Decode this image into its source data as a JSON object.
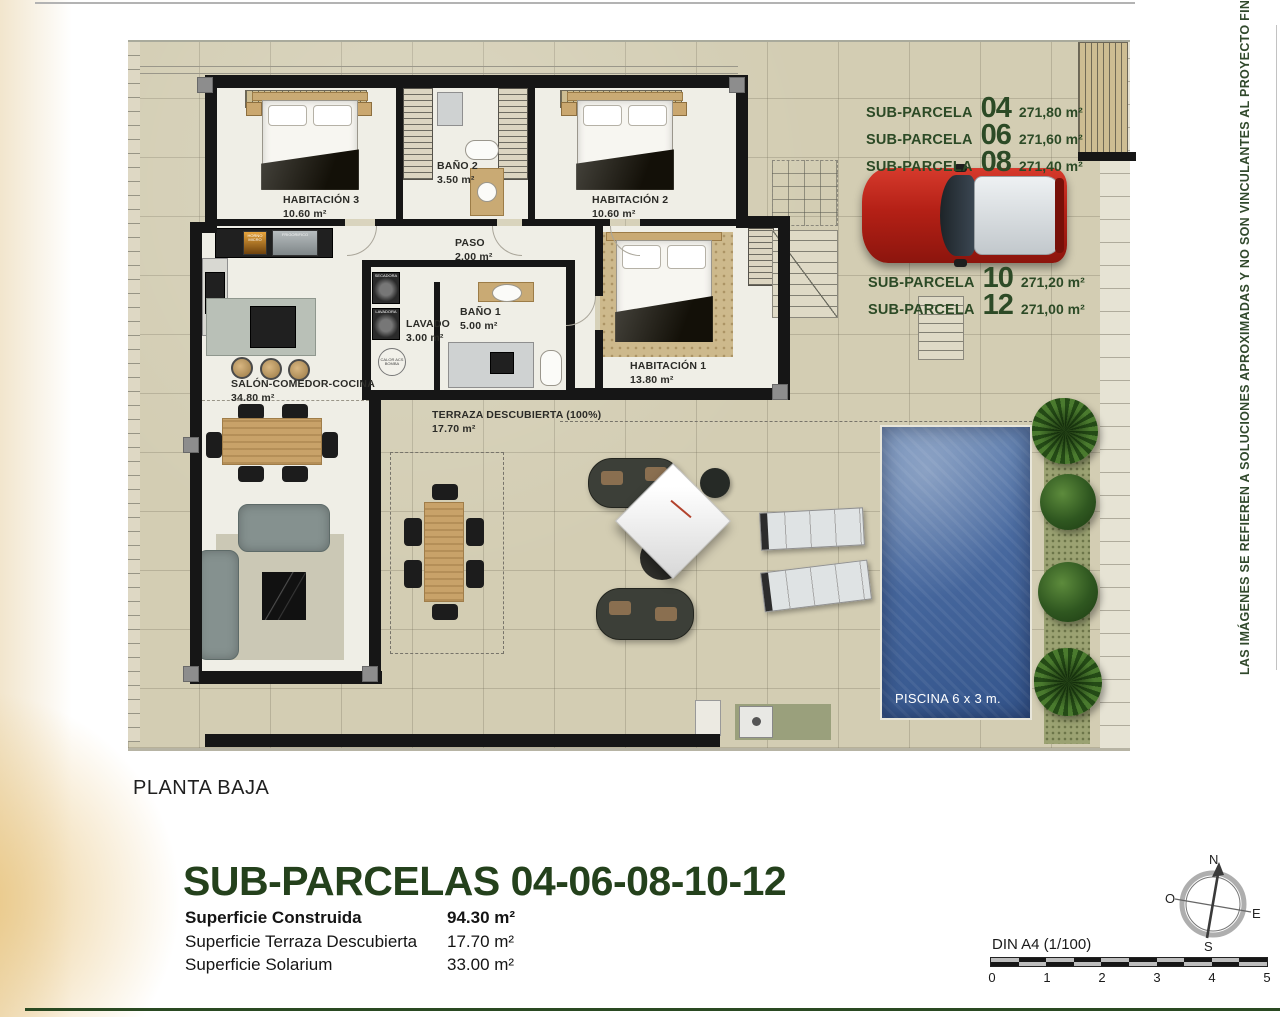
{
  "parcels": {
    "top": [
      {
        "name": "SUB-PARCELA",
        "num": "04",
        "area": "271,80 m²"
      },
      {
        "name": "SUB-PARCELA",
        "num": "06",
        "area": "271,60 m²"
      },
      {
        "name": "SUB-PARCELA",
        "num": "08",
        "area": "271,40 m²"
      }
    ],
    "mid": [
      {
        "name": "SUB-PARCELA",
        "num": "10",
        "area": "271,20 m²"
      },
      {
        "name": "SUB-PARCELA",
        "num": "12",
        "area": "271,00 m²"
      }
    ]
  },
  "rooms": {
    "hab3": {
      "name": "HABITACIÓN 3",
      "area": "10.60 m²"
    },
    "bano2": {
      "name": "BAÑO 2",
      "area": "3.50 m²"
    },
    "hab2": {
      "name": "HABITACIÓN 2",
      "area": "10.60 m²"
    },
    "paso": {
      "name": "PASO",
      "area": "2.00 m²"
    },
    "lavado": {
      "name": "LAVADO",
      "area": "3.00 m²"
    },
    "bano1": {
      "name": "BAÑO 1",
      "area": "5.00 m²"
    },
    "hab1": {
      "name": "HABITACIÓN 1",
      "area": "13.80 m²"
    },
    "salon": {
      "name": "SALÓN-COMEDOR-COCINA",
      "area": "34.80 m²"
    },
    "terraza": {
      "name": "TERRAZA DESCUBIERTA (100%)",
      "area": "17.70 m²"
    }
  },
  "appliances": {
    "oven": "HORNO MICRO",
    "fridge": "FRIGORIFICO",
    "dryer": "SECADORA",
    "washer": "LAVADORA",
    "boiler": "CALOR ACS BOMBA"
  },
  "pool": {
    "label": "PISCINA 6 x 3 m."
  },
  "floor": {
    "label": "PLANTA BAJA"
  },
  "title": {
    "text": "SUB-PARCELAS 04-06-08-10-12"
  },
  "summary": [
    {
      "label": "Superficie Construida",
      "value": "94.30 m²"
    },
    {
      "label": "Superficie Terraza Descubierta",
      "value": "17.70 m²"
    },
    {
      "label": "Superficie Solarium",
      "value": "33.00 m²"
    }
  ],
  "compass": {
    "n": "N",
    "s": "S",
    "e": "E",
    "w": "O"
  },
  "scale": {
    "label": "DIN A4 (1/100)",
    "ticks": [
      "0",
      "1",
      "2",
      "3",
      "4",
      "5"
    ]
  },
  "disclaimer": "LAS IMÁGENES SE REFIEREN A SOLUCIONES APROXIMADAS Y NO SON VINCULANTES AL PROYECTO FINAL",
  "colors": {
    "accent_green": "#24411c",
    "pool_blue": "#48699f",
    "car_red": "#b42016"
  }
}
